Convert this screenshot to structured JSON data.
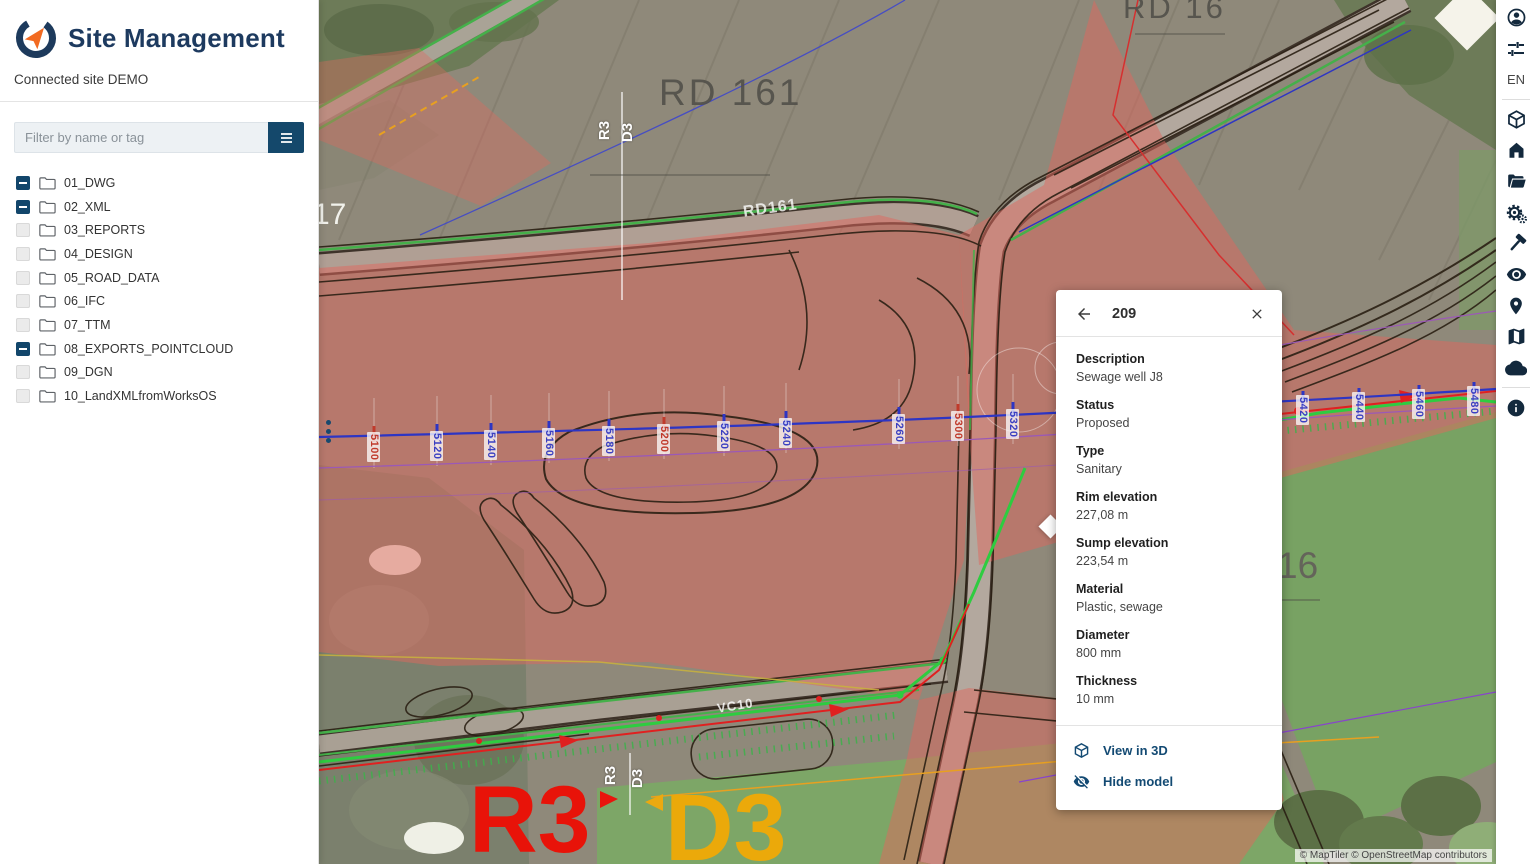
{
  "app": {
    "title": "Site Management",
    "connected_site": "Connected site DEMO"
  },
  "sidebar": {
    "filter": {
      "placeholder": "Filter by name or tag"
    },
    "tree": [
      {
        "label": "01_DWG",
        "state": "indeterminate"
      },
      {
        "label": "02_XML",
        "state": "indeterminate"
      },
      {
        "label": "03_REPORTS",
        "state": "unchecked"
      },
      {
        "label": "04_DESIGN",
        "state": "unchecked"
      },
      {
        "label": "05_ROAD_DATA",
        "state": "unchecked"
      },
      {
        "label": "06_IFC",
        "state": "unchecked"
      },
      {
        "label": "07_TTM",
        "state": "unchecked"
      },
      {
        "label": "08_EXPORTS_POINTCLOUD",
        "state": "indeterminate"
      },
      {
        "label": "09_DGN",
        "state": "unchecked"
      },
      {
        "label": "10_LandXMLfromWorksOS",
        "state": "unchecked"
      }
    ]
  },
  "map": {
    "labels": {
      "rd161_big": "RD 161",
      "rd16": "RD 16",
      "rd161_road": "RD161",
      "vc10": "VC10",
      "route17": "17",
      "route16": "16",
      "r3_big": "R3",
      "d3_big": "D3",
      "r3_marker_top": "R3",
      "d3_marker_top": "D3",
      "r3_marker_bottom": "R3",
      "d3_marker_bottom": "D3"
    },
    "stations": [
      {
        "value": "5100",
        "color": "#c03a2b"
      },
      {
        "value": "5120",
        "color": "#3a3fc1"
      },
      {
        "value": "5140",
        "color": "#3a3fc1"
      },
      {
        "value": "5160",
        "color": "#3a3fc1"
      },
      {
        "value": "5180",
        "color": "#3a3fc1"
      },
      {
        "value": "5200",
        "color": "#c03a2b"
      },
      {
        "value": "5220",
        "color": "#3a3fc1"
      },
      {
        "value": "5240",
        "color": "#3a3fc1"
      },
      {
        "value": "5260",
        "color": "#3a3fc1"
      },
      {
        "value": "5300",
        "color": "#c03a2b"
      },
      {
        "value": "5320",
        "color": "#3a3fc1"
      },
      {
        "value": "5420",
        "color": "#3a3fc1"
      },
      {
        "value": "5440",
        "color": "#3a3fc1"
      },
      {
        "value": "5460",
        "color": "#3a3fc1"
      },
      {
        "value": "5480",
        "color": "#3a3fc1"
      }
    ],
    "attribution": "© MapTiler © OpenStreetMap contributors"
  },
  "panel": {
    "title": "209",
    "fields": [
      {
        "label": "Description",
        "value": "Sewage well J8"
      },
      {
        "label": "Status",
        "value": "Proposed"
      },
      {
        "label": "Type",
        "value": "Sanitary"
      },
      {
        "label": "Rim elevation",
        "value": "227,08 m"
      },
      {
        "label": "Sump elevation",
        "value": "223,54 m"
      },
      {
        "label": "Material",
        "value": "Plastic, sewage"
      },
      {
        "label": "Diameter",
        "value": "800 mm"
      },
      {
        "label": "Thickness",
        "value": "10 mm"
      }
    ],
    "actions": [
      {
        "icon": "cube-3d-icon",
        "label": "View in 3D"
      },
      {
        "icon": "eye-off-icon",
        "label": "Hide model"
      }
    ]
  },
  "toolbar": {
    "language": "EN"
  },
  "colors": {
    "brand_navy": "#1d3a5f",
    "accent_orange": "#f26a21",
    "overlay_pink": "#e0685e",
    "centerline_blue": "#2d35c4",
    "design_green": "#2ecc40",
    "station_red": "#c03a2b"
  }
}
